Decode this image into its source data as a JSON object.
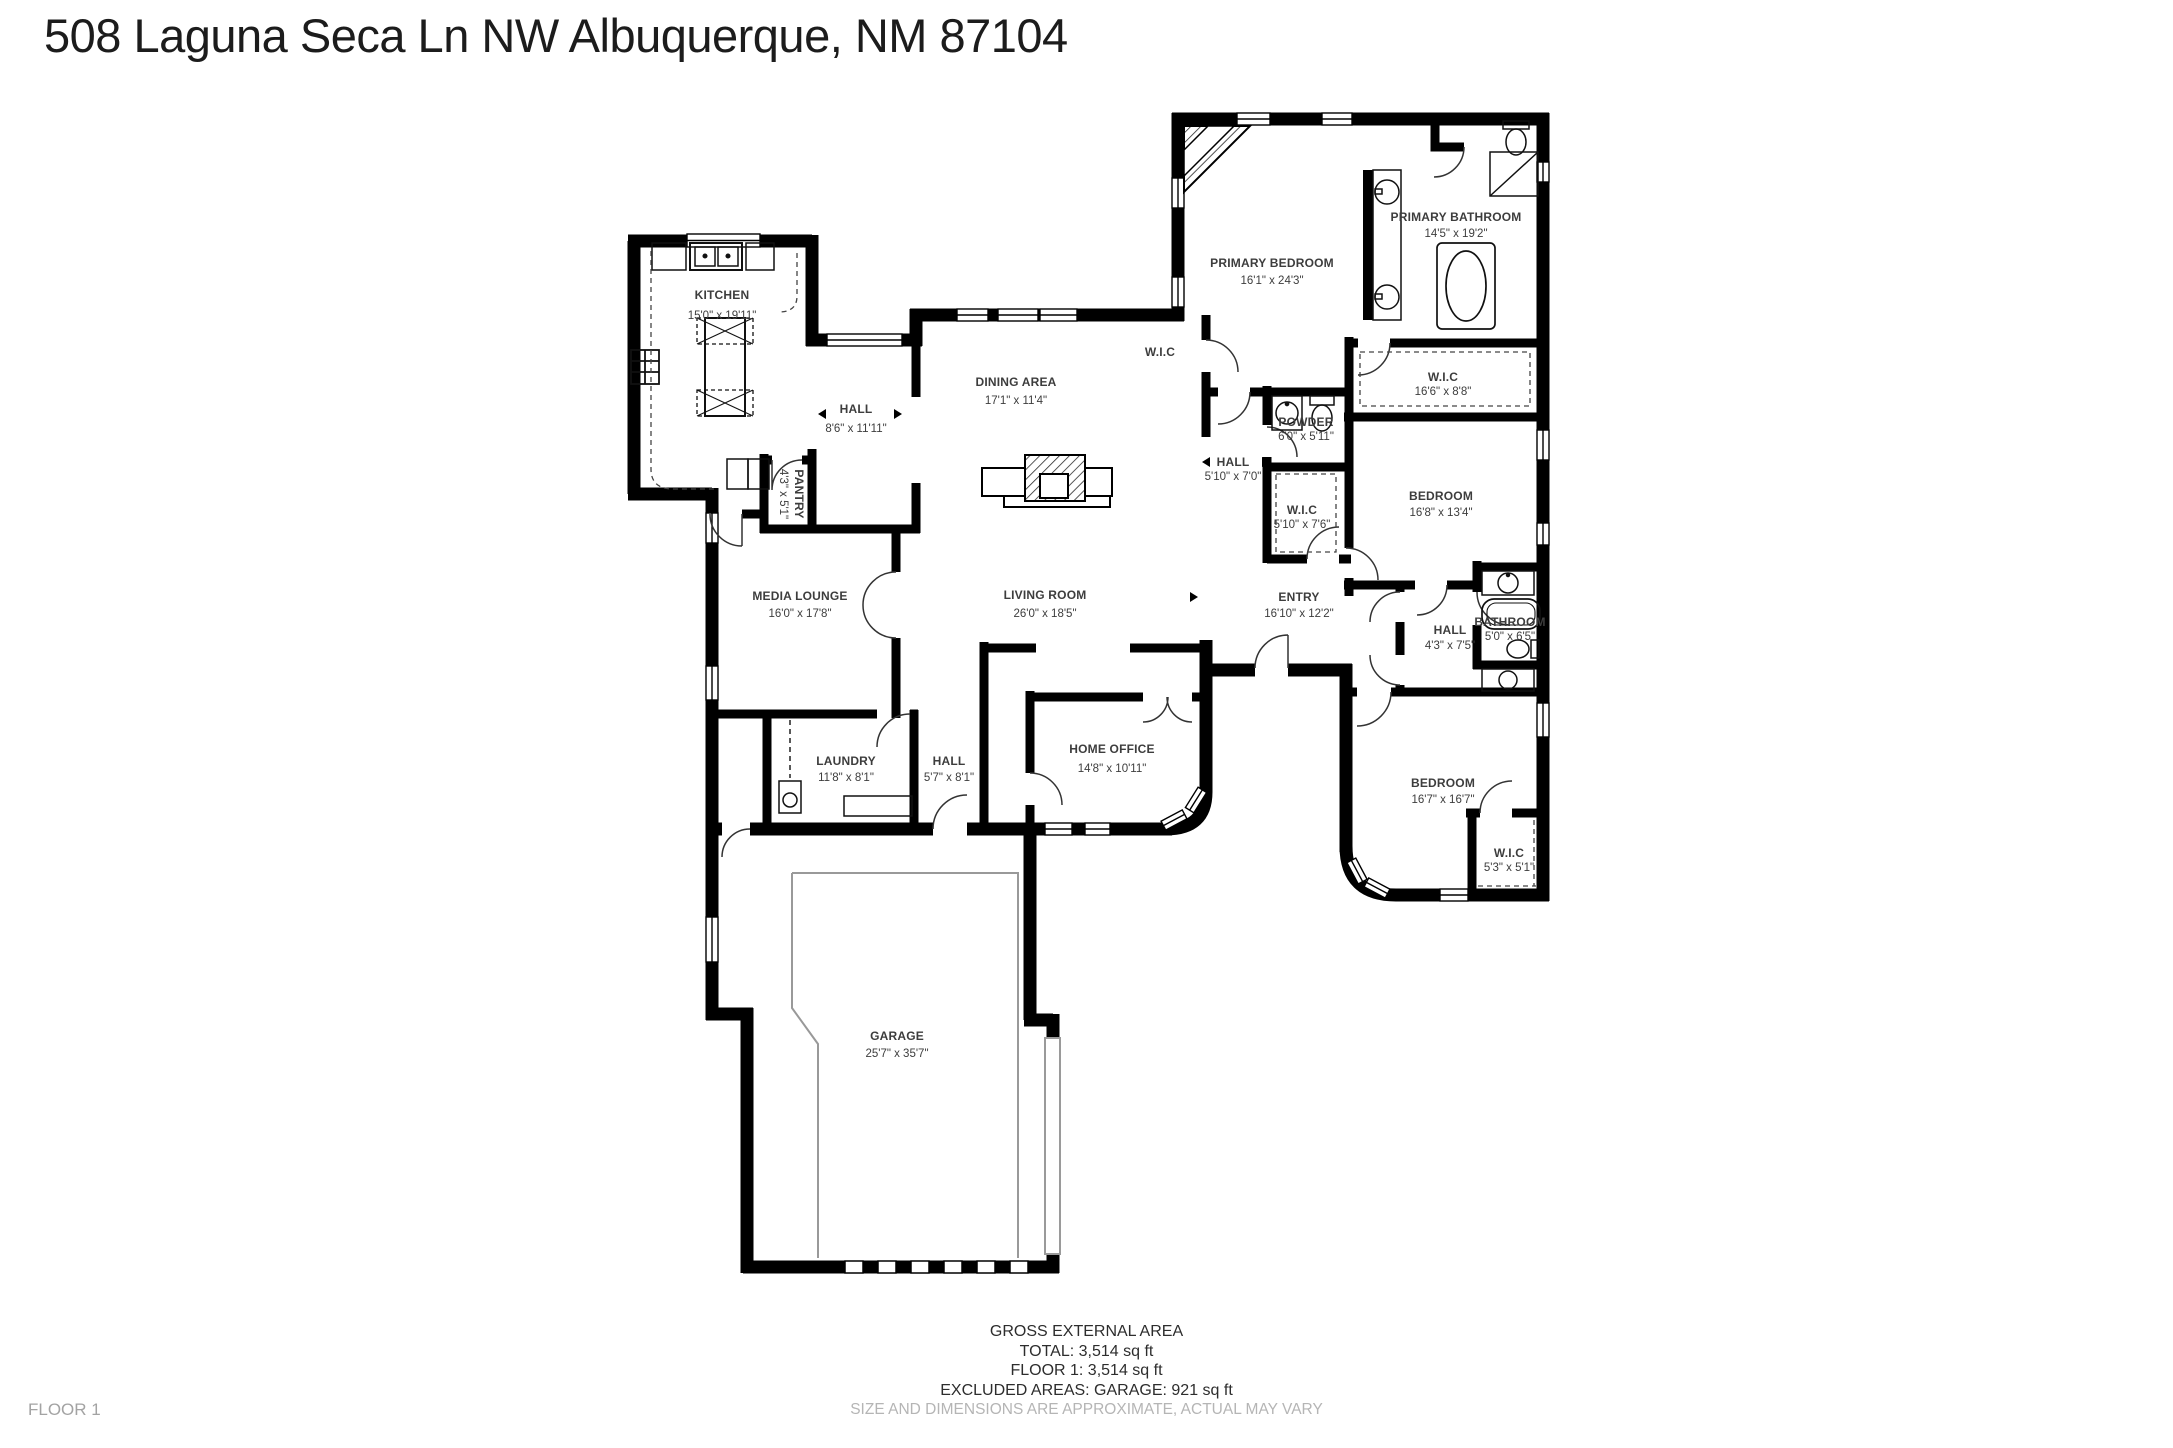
{
  "meta": {
    "title": "508 Laguna Seca Ln NW Albuquerque, NM 87104"
  },
  "rooms": [
    {
      "id": "kitchen",
      "name": "KITCHEN",
      "dims": "15'0\" x 19'11\""
    },
    {
      "id": "hall-kitchen",
      "name": "HALL",
      "dims": "8'6\" x 11'11\""
    },
    {
      "id": "pantry",
      "name": "PANTRY",
      "dims": "4'3\" x 5'1\""
    },
    {
      "id": "dining-area",
      "name": "DINING AREA",
      "dims": "17'1\" x 11'4\""
    },
    {
      "id": "wic-dining",
      "name": "W.I.C",
      "dims": ""
    },
    {
      "id": "powder",
      "name": "POWDER",
      "dims": "6'0\" x 5'11\""
    },
    {
      "id": "hall-powder",
      "name": "HALL",
      "dims": "5'10\" x 7'0\""
    },
    {
      "id": "wic-entry",
      "name": "W.I.C",
      "dims": "5'10\" x 7'6\""
    },
    {
      "id": "living-room",
      "name": "LIVING ROOM",
      "dims": "26'0\" x 18'5\""
    },
    {
      "id": "entry",
      "name": "ENTRY",
      "dims": "16'10\" x 12'2\""
    },
    {
      "id": "primary-bedroom",
      "name": "PRIMARY BEDROOM",
      "dims": "16'1\" x 24'3\""
    },
    {
      "id": "primary-bathroom",
      "name": "PRIMARY BATHROOM",
      "dims": "14'5\" x 19'2\""
    },
    {
      "id": "wic-primary",
      "name": "W.I.C",
      "dims": "16'6\" x 8'8\""
    },
    {
      "id": "bedroom-1",
      "name": "BEDROOM",
      "dims": "16'8\" x 13'4\""
    },
    {
      "id": "hall-bedroom",
      "name": "HALL",
      "dims": "4'3\" x 7'5\""
    },
    {
      "id": "bathroom",
      "name": "BATHROOM",
      "dims": "5'0\" x 6'5\""
    },
    {
      "id": "bedroom-2",
      "name": "BEDROOM",
      "dims": "16'7\" x 16'7\""
    },
    {
      "id": "wic-bedroom2",
      "name": "W.I.C",
      "dims": "5'3\" x 5'1\""
    },
    {
      "id": "media-lounge",
      "name": "MEDIA LOUNGE",
      "dims": "16'0\" x 17'8\""
    },
    {
      "id": "laundry",
      "name": "LAUNDRY",
      "dims": "11'8\" x 8'1\""
    },
    {
      "id": "hall-laundry",
      "name": "HALL",
      "dims": "5'7\" x 8'1\""
    },
    {
      "id": "home-office",
      "name": "HOME OFFICE",
      "dims": "14'8\" x 10'11\""
    },
    {
      "id": "garage",
      "name": "GARAGE",
      "dims": "25'7\" x 35'7\""
    }
  ],
  "footer": {
    "lines": [
      "GROSS EXTERNAL AREA",
      "TOTAL: 3,514 sq ft",
      "FLOOR 1: 3,514 sq ft",
      "EXCLUDED AREAS: GARAGE: 921 sq ft"
    ],
    "disclaimer": "SIZE AND DIMENSIONS ARE APPROXIMATE, ACTUAL MAY VARY",
    "floor_label": "FLOOR 1"
  },
  "colors": {
    "wall": "#000000",
    "label": "#3d3d3d",
    "muted": "#b5b5b5"
  }
}
